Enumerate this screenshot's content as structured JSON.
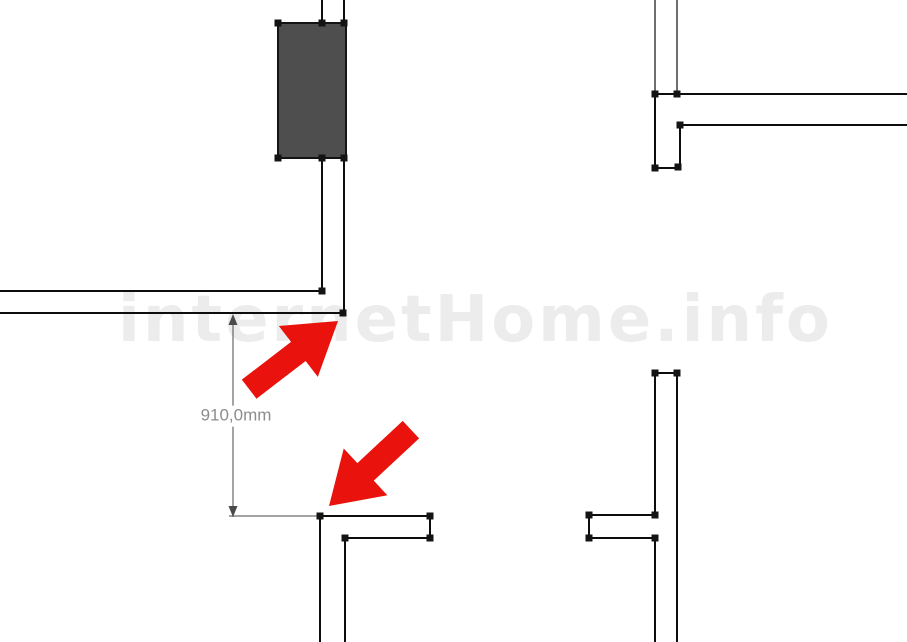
{
  "canvas": {
    "width": 907,
    "height": 642,
    "background": "#ffffff"
  },
  "watermark": {
    "text": "internetHome.info",
    "color": "#ececec"
  },
  "dimension": {
    "label": "910,0mm",
    "line_color": "#4a4a4a",
    "text_color": "#8c8c8c",
    "line": {
      "x": 233,
      "y1": 315,
      "y2": 517
    },
    "extension": {
      "x1": 229,
      "x2": 319,
      "y": 516
    },
    "label_pos": {
      "x": 236,
      "y": 416
    }
  },
  "drawing": {
    "wall_color": "#0d0d0d",
    "handle_color": "#141414",
    "handle_size": 7,
    "door": {
      "x": 278,
      "y": 23,
      "w": 68,
      "h": 135,
      "fill": "#4e4e4e",
      "stroke": "#141414"
    },
    "walls": [
      {
        "x1": 322,
        "y1": 0,
        "x2": 322,
        "y2": 24,
        "w": 2
      },
      {
        "x1": 344,
        "y1": 0,
        "x2": 344,
        "y2": 24,
        "w": 2
      },
      {
        "x1": 322,
        "y1": 157,
        "x2": 322,
        "y2": 292,
        "w": 2
      },
      {
        "x1": 344,
        "y1": 157,
        "x2": 344,
        "y2": 314,
        "w": 2
      },
      {
        "x1": 0,
        "y1": 291,
        "x2": 323,
        "y2": 291,
        "w": 2
      },
      {
        "x1": 0,
        "y1": 313,
        "x2": 345,
        "y2": 313,
        "w": 2
      },
      {
        "x1": 655,
        "y1": 0,
        "x2": 655,
        "y2": 95,
        "w": 1.2
      },
      {
        "x1": 677,
        "y1": 0,
        "x2": 677,
        "y2": 94,
        "w": 1.2
      },
      {
        "x1": 655,
        "y1": 94,
        "x2": 655,
        "y2": 169,
        "w": 2
      },
      {
        "x1": 654,
        "y1": 94,
        "x2": 907,
        "y2": 94,
        "w": 2
      },
      {
        "x1": 680,
        "y1": 125,
        "x2": 907,
        "y2": 125,
        "w": 2
      },
      {
        "x1": 680,
        "y1": 125,
        "x2": 680,
        "y2": 168,
        "w": 2
      },
      {
        "x1": 654,
        "y1": 168,
        "x2": 681,
        "y2": 168,
        "w": 2
      },
      {
        "x1": 654,
        "y1": 373,
        "x2": 678,
        "y2": 373,
        "w": 2
      },
      {
        "x1": 677,
        "y1": 373,
        "x2": 677,
        "y2": 642,
        "w": 2
      },
      {
        "x1": 655,
        "y1": 373,
        "x2": 655,
        "y2": 516,
        "w": 2
      },
      {
        "x1": 588,
        "y1": 515,
        "x2": 656,
        "y2": 515,
        "w": 2
      },
      {
        "x1": 589,
        "y1": 515,
        "x2": 589,
        "y2": 539,
        "w": 2
      },
      {
        "x1": 588,
        "y1": 538,
        "x2": 656,
        "y2": 538,
        "w": 2
      },
      {
        "x1": 655,
        "y1": 538,
        "x2": 655,
        "y2": 642,
        "w": 2
      },
      {
        "x1": 319,
        "y1": 516,
        "x2": 431,
        "y2": 516,
        "w": 2
      },
      {
        "x1": 430,
        "y1": 516,
        "x2": 430,
        "y2": 539,
        "w": 2
      },
      {
        "x1": 344,
        "y1": 538,
        "x2": 431,
        "y2": 538,
        "w": 2
      },
      {
        "x1": 320,
        "y1": 516,
        "x2": 320,
        "y2": 642,
        "w": 2
      },
      {
        "x1": 345,
        "y1": 538,
        "x2": 345,
        "y2": 642,
        "w": 2
      }
    ],
    "handles": [
      [
        278,
        23
      ],
      [
        322,
        23
      ],
      [
        344,
        23
      ],
      [
        278,
        158
      ],
      [
        322,
        158
      ],
      [
        344,
        158
      ],
      [
        322,
        291
      ],
      [
        343,
        313
      ],
      [
        655,
        94
      ],
      [
        677,
        94
      ],
      [
        680,
        125
      ],
      [
        655,
        168
      ],
      [
        678,
        167
      ],
      [
        655,
        373
      ],
      [
        677,
        373
      ],
      [
        655,
        515
      ],
      [
        589,
        515
      ],
      [
        589,
        538
      ],
      [
        655,
        538
      ],
      [
        320,
        516
      ],
      [
        430,
        516
      ],
      [
        430,
        538
      ],
      [
        345,
        538
      ]
    ],
    "arrows": [
      {
        "tip": [
          338,
          321
        ],
        "angle": -37.5,
        "color": "#e9120c"
      },
      {
        "tip": [
          329,
          506
        ],
        "angle": 137,
        "color": "#e9120c"
      }
    ],
    "arrow_shape": "0,0 -50,32 -50,12 -112,12 -112,-12 -50,-12 -50,-32",
    "dim_arrowhead_shape": "0,0 -4.5,11 4.5,11"
  }
}
